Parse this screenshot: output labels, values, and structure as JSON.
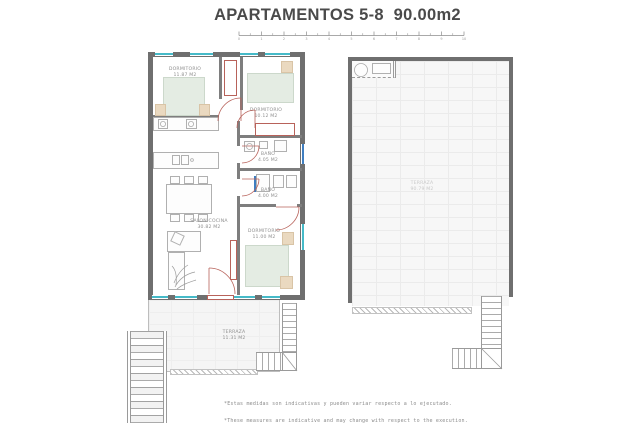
{
  "page": {
    "title": "APARTAMENTOS 5-8  90.00m2"
  },
  "scale_bar": {
    "unit_ticks": [
      "0",
      "1",
      "2",
      "3",
      "4",
      "5",
      "6",
      "7",
      "8",
      "9",
      "10"
    ]
  },
  "apartment": {
    "rooms": {
      "dormitorio1": {
        "name": "DORMITORIO",
        "area": "11.87 M2"
      },
      "dormitorio2": {
        "name": "DORMITORIO",
        "area": "10.12 M2"
      },
      "bano1": {
        "name": "BAÑO",
        "area": "4.05 M2"
      },
      "bano2": {
        "name": "BAÑO",
        "area": "4.00 M2"
      },
      "salon_cocina": {
        "name": "SALON COCINA",
        "area": "30.82 M2"
      },
      "dormitorio3": {
        "name": "DORMITORIO",
        "area": "11.00 M2"
      },
      "terraza": {
        "name": "TERRAZA",
        "area": "11.31 M2"
      }
    }
  },
  "solarium": {
    "room": {
      "name": "TERRAZA",
      "area": "90.79 M2"
    }
  },
  "footnotes": {
    "es": "*Estas medidas son indicativas y pueden variar respecto a lo ejecutado.",
    "en": "*These measures are indicative and may change with respect to the execution."
  },
  "colors": {
    "wall": "#6f6f6f",
    "partition": "#7e7e7e",
    "door": "#b8625a",
    "window_teal": "#45bac8",
    "window_blue": "#3f7ec0",
    "bed_fill": "#e4ece3",
    "wood_fill": "#ead9c0",
    "label_text": "#8f8f8f"
  }
}
